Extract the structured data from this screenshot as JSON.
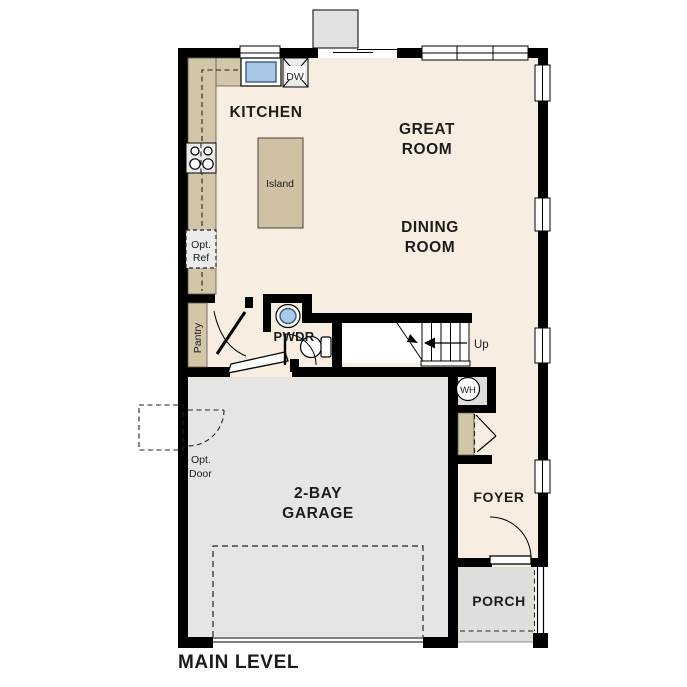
{
  "title": {
    "main_level": "MAIN LEVEL"
  },
  "rooms": {
    "kitchen": "KITCHEN",
    "great_room_line1": "GREAT",
    "great_room_line2": "ROOM",
    "dining_room_line1": "DINING",
    "dining_room_line2": "ROOM",
    "garage_line1": "2-BAY",
    "garage_line2": "GARAGE",
    "foyer": "FOYER",
    "porch": "PORCH",
    "pwdr": "PWDR",
    "pantry": "Pantry"
  },
  "fixtures": {
    "island": "Island",
    "dishwasher": "DW",
    "water_heater": "WH",
    "opt_ref_line1": "Opt.",
    "opt_ref_line2": "Ref",
    "opt_door_line1": "Opt.",
    "opt_door_line2": "Door",
    "stairs_up": "Up"
  },
  "colors": {
    "wall": "#000000",
    "floor": "#f7eee1",
    "garage": "#e7e5e2",
    "porch": "#e0dedb",
    "counter": "#d3c5a7",
    "island": "#cfc1a3",
    "chimney": "#e3e2e0",
    "closetgray": "#dedddb",
    "sinkblue": "#a9c7e8"
  }
}
